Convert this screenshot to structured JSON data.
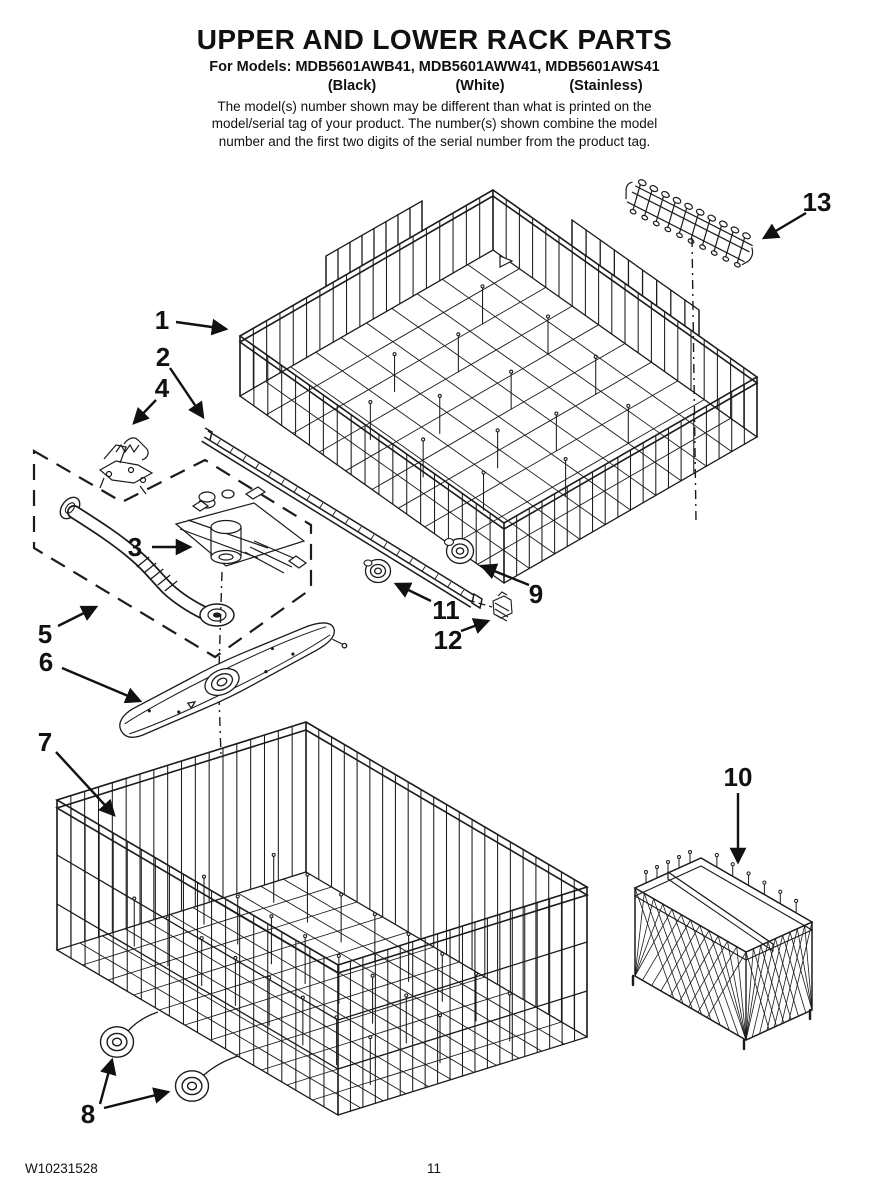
{
  "header": {
    "title": "UPPER AND LOWER RACK PARTS",
    "models_line": "For Models: MDB5601AWB41, MDB5601AWW41, MDB5601AWS41",
    "finish_labels": [
      "(Black)",
      "(White)",
      "(Stainless)"
    ],
    "note_lines": [
      "The model(s) number shown may be different than what is printed on the",
      "model/serial tag of your product. The number(s) shown combine the model",
      "number and the first two digits of the serial number from the product tag."
    ]
  },
  "callouts": {
    "c1": "1",
    "c2": "2",
    "c3": "3",
    "c4": "4",
    "c5": "5",
    "c6": "6",
    "c7": "7",
    "c8": "8",
    "c9": "9",
    "c10": "10",
    "c11": "11",
    "c12": "12",
    "c13": "13"
  },
  "footer": {
    "document_number": "W10231528",
    "page_number": "11"
  },
  "colors": {
    "ink": "#1b1b1b",
    "paper": "#ffffff"
  }
}
